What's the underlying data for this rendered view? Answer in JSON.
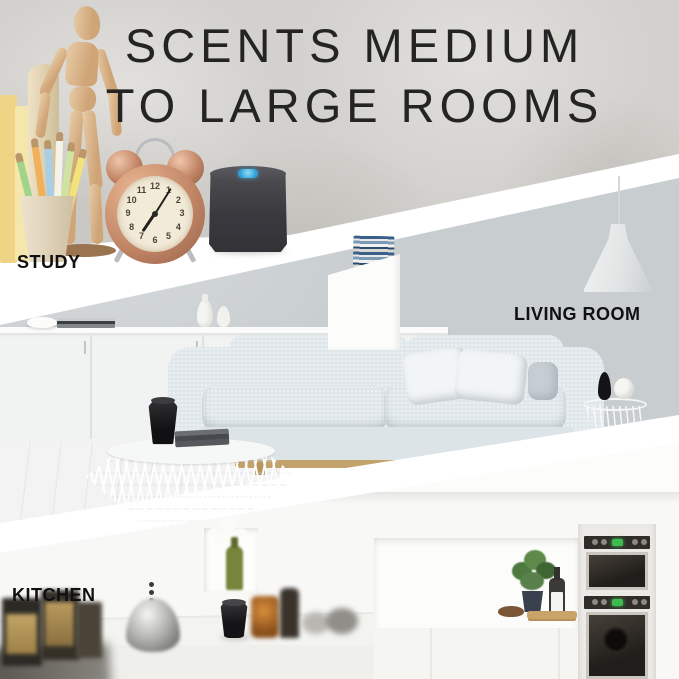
{
  "page": {
    "width": 679,
    "height": 679,
    "background": "#ffffff",
    "type": "product-infographic"
  },
  "headline": {
    "line1": "SCENTS MEDIUM",
    "line2": "TO LARGE ROOMS",
    "color": "#242424"
  },
  "sections": [
    {
      "id": "study",
      "label": "STUDY"
    },
    {
      "id": "living-room",
      "label": "LIVING ROOM"
    },
    {
      "id": "kitchen",
      "label": "KITCHEN"
    }
  ],
  "study": {
    "clock_numerals": [
      "12",
      "1",
      "2",
      "3",
      "4",
      "5",
      "6",
      "7",
      "8",
      "9",
      "10",
      "11"
    ],
    "clock_time_approx": "1:07"
  },
  "colors": {
    "label_text": "#101010",
    "study_wall": "#d3d1cd",
    "living_wall": "#c8cdd0",
    "kitchen_wall": "#f8f8f6",
    "divider_band": "#ffffff",
    "diffuser_body_dark": "#3a393e",
    "diffuser_button_blue": "#2e9fd6",
    "clock_copper": "#c08464",
    "oven_indicator_green": "#3dbb4e",
    "sofa_fabric": "#e0e7eb",
    "sofa_rail_wood": "#c2a36b"
  }
}
